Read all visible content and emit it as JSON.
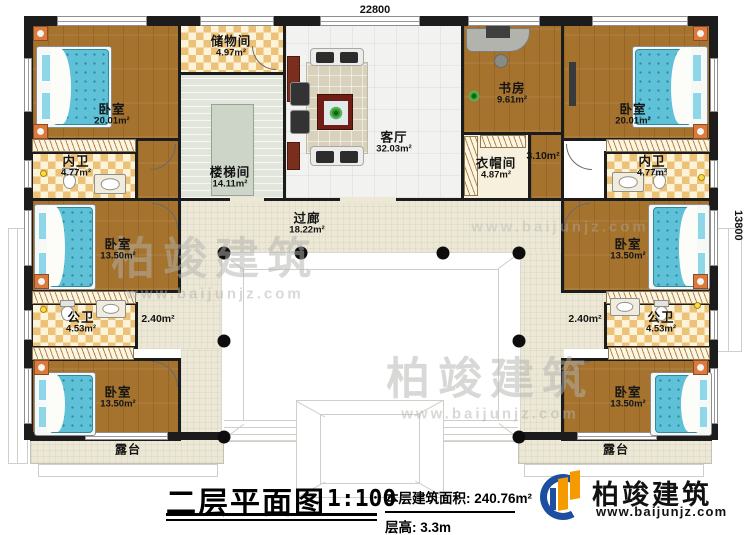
{
  "dimensions": {
    "top": "22800",
    "right": "13800"
  },
  "rooms": {
    "bedroom_tl": {
      "label": "卧室",
      "area": "20.01m²"
    },
    "bath_inner_left": {
      "label": "内卫",
      "area": "4.77m²"
    },
    "bedroom_ml": {
      "label": "卧室",
      "area": "13.50m²"
    },
    "bath_public_left": {
      "label": "公卫",
      "area": "4.53m²"
    },
    "nook_left": {
      "area": "2.40m²"
    },
    "bedroom_bl": {
      "label": "卧室",
      "area": "13.50m²"
    },
    "terrace_left": {
      "label": "露台"
    },
    "storage": {
      "label": "储物间",
      "area": "4.97m²"
    },
    "stairwell": {
      "label": "楼梯间",
      "area": "14.11m²"
    },
    "living": {
      "label": "客厅",
      "area": "32.03m²"
    },
    "corridor": {
      "label": "过廊",
      "area": "18.22m²"
    },
    "study": {
      "label": "书房",
      "area": "9.61m²"
    },
    "cloak": {
      "label": "衣帽间",
      "area": "4.87m²"
    },
    "hall_right": {
      "area": "3.10m²"
    },
    "bedroom_tr": {
      "label": "卧室",
      "area": "20.01m²"
    },
    "bath_inner_right": {
      "label": "内卫",
      "area": "4.77m²"
    },
    "bedroom_mr": {
      "label": "卧室",
      "area": "13.50m²"
    },
    "bath_public_right": {
      "label": "公卫",
      "area": "4.53m²"
    },
    "nook_right": {
      "area": "2.40m²"
    },
    "bedroom_br": {
      "label": "卧室",
      "area": "13.50m²"
    },
    "terrace_right": {
      "label": "露台"
    }
  },
  "footer": {
    "title": "二层平面图",
    "scale": "1:100",
    "area_label": "本层建筑面积:",
    "area_value": "240.76m²",
    "height_label": "层高:",
    "height_value": "3.3m",
    "brand": "柏竣建筑",
    "website": "www.baijunjz.com"
  },
  "watermark": {
    "text": "柏竣建筑",
    "site": "www.baijunjz.com"
  },
  "colors": {
    "wall": "#1c1c1c",
    "wood": "#a5732e",
    "brand_blue": "#1d4fa1",
    "brand_orange": "#f59a00"
  }
}
